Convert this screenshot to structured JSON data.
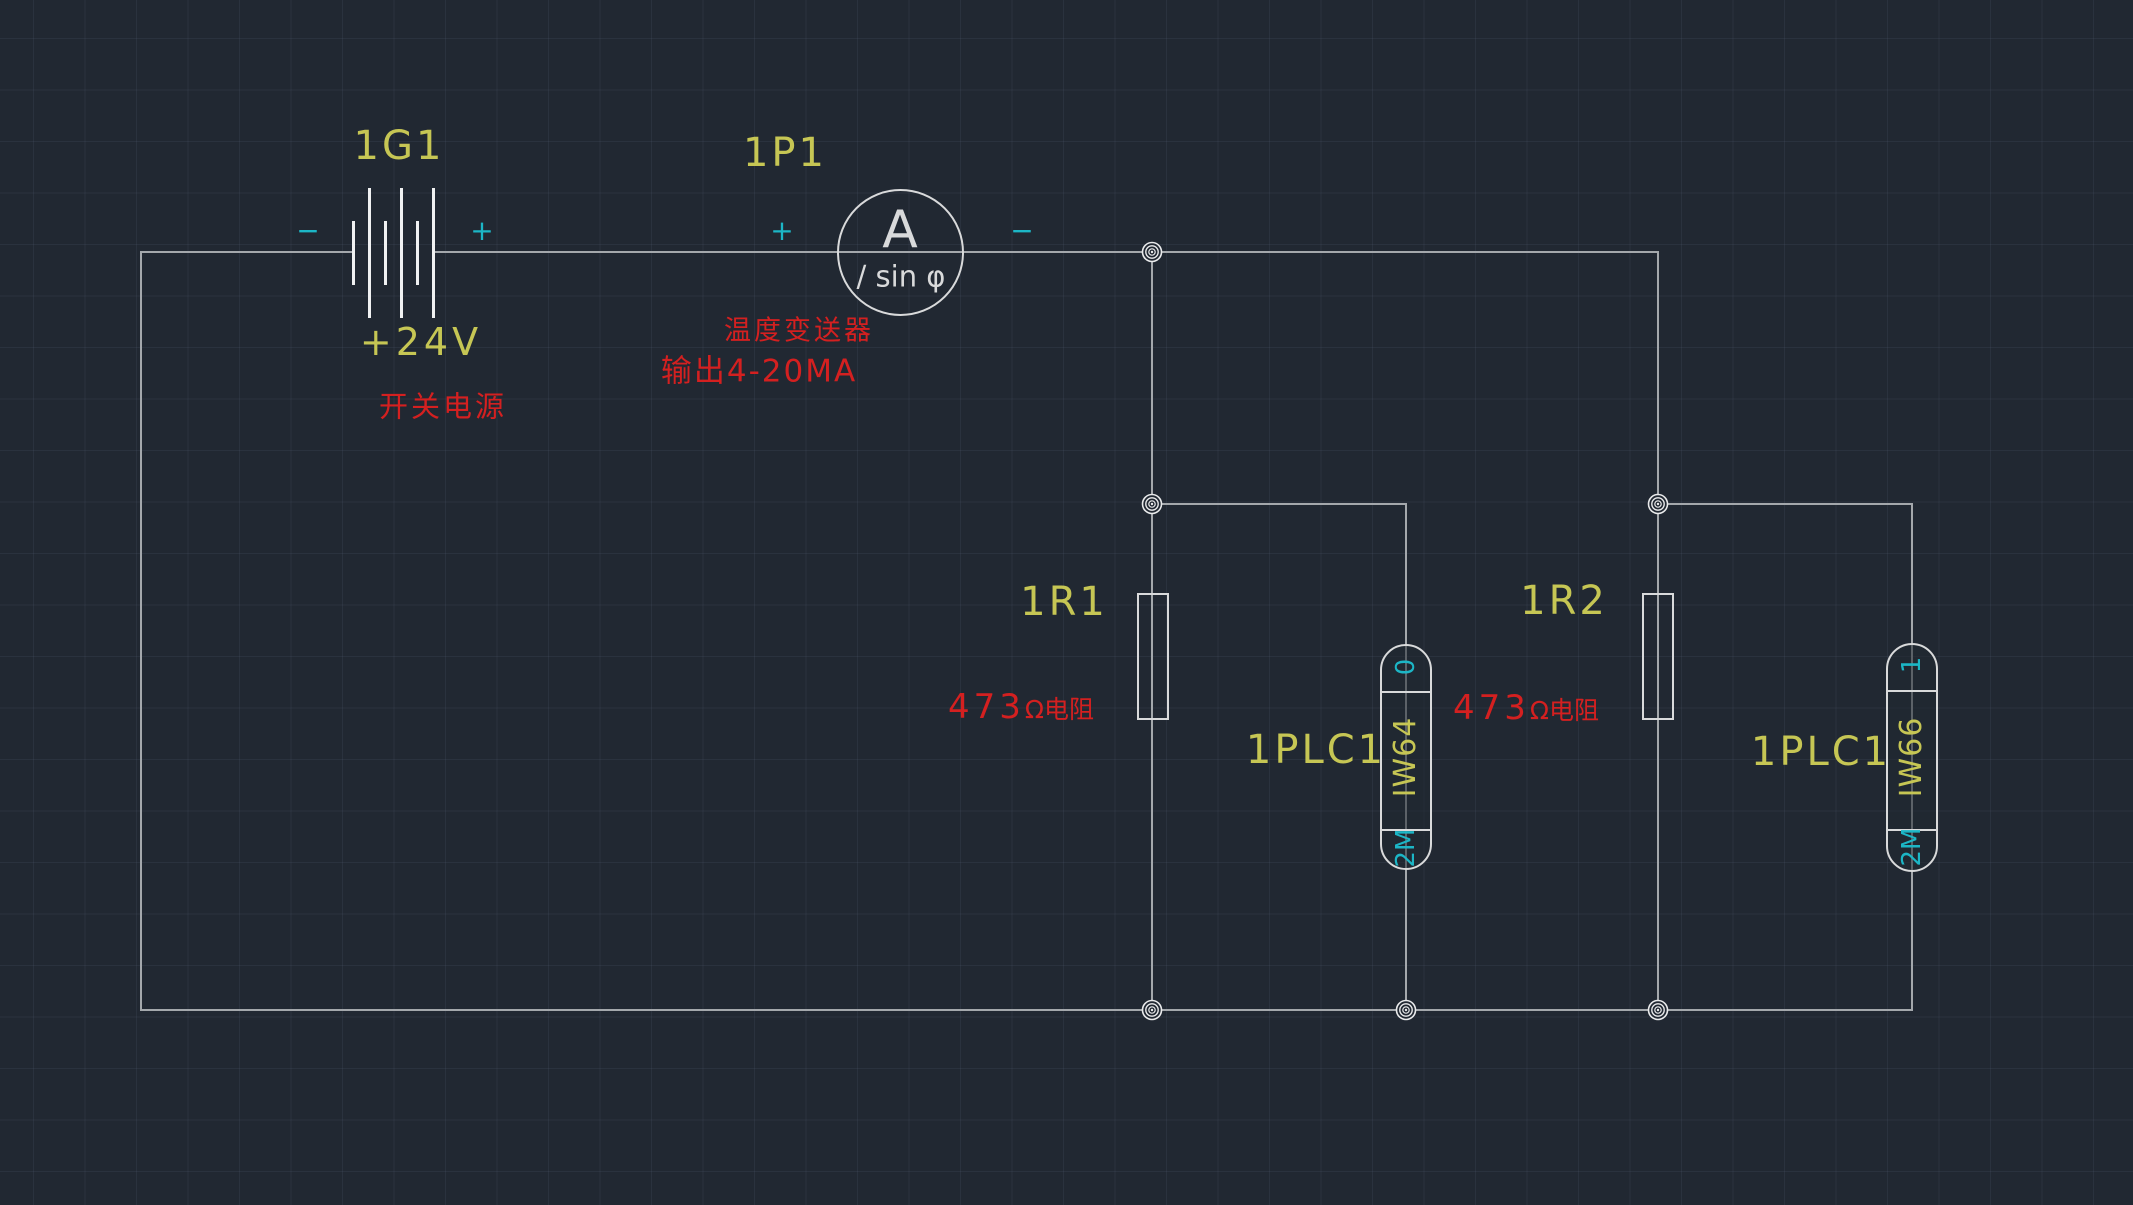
{
  "drawing": {
    "type": "electrical-circuit-cad-drawing",
    "colors": {
      "background": "#212832",
      "wire": "#a4a8ac",
      "symbol": "#d9dadb",
      "reference_text": "#c6c654",
      "annotation_text": "#d42020",
      "polarity_text": "#1cb6c6"
    }
  },
  "power_supply": {
    "ref": "1G1",
    "voltage": "+24V",
    "description": "开关电源",
    "terminal_minus": "−",
    "terminal_plus": "+"
  },
  "transmitter_meter": {
    "ref": "1P1",
    "meter_letter": "A",
    "meter_function": "/ sin φ",
    "terminal_plus": "+",
    "terminal_minus": "−",
    "description_line1": "温度变送器",
    "description_line2": "输出4-20MA"
  },
  "resistors": [
    {
      "ref": "1R1",
      "value": "473",
      "unit_desc": "Ω电阻"
    },
    {
      "ref": "1R2",
      "value": "473",
      "unit_desc": "Ω电阻"
    }
  ],
  "plc_inputs": [
    {
      "device_ref": "1PLC1",
      "address": "IW64",
      "pin_top": "0",
      "pin_bottom": "2M"
    },
    {
      "device_ref": "1PLC1",
      "address": "IW66",
      "pin_top": "1",
      "pin_bottom": "2M"
    }
  ]
}
